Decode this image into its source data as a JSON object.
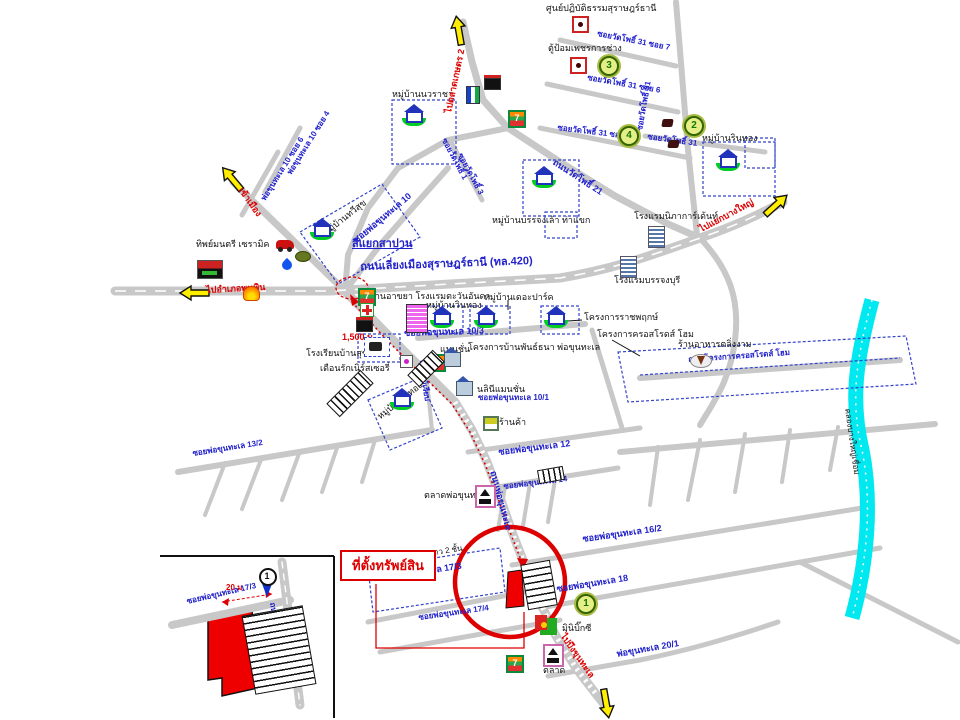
{
  "map": {
    "property_label": "ที่ตั้งทรัพย์สิน",
    "colors": {
      "road": "#c8c8c8",
      "canal": "#00e8f0",
      "route": "#dd0000",
      "road_label": "#2222cc",
      "village_box": "#3344cc",
      "arrow": "#ffee00"
    },
    "labels": [
      {
        "name": "meditation-center-label",
        "text": "ศูนย์ปฏิบัติธรรมสุราษฎร์ธานี",
        "x": 546,
        "y": 4,
        "cls": "lbl-place"
      },
      {
        "name": "police-box-label",
        "text": "ตู้ป้อมเพชรการช่าง",
        "x": 548,
        "y": 44,
        "cls": "lbl-place"
      },
      {
        "name": "soi-watpho-31-7",
        "text": "ซอยวัดโพธิ์ 31 ซอย 7",
        "x": 598,
        "y": 30,
        "rot": 11,
        "cls": "lbl-road lbl-small"
      },
      {
        "name": "soi-watpho-31-6",
        "text": "ซอยวัดโพธิ์ 31 ซอย 6",
        "x": 588,
        "y": 74,
        "rot": 10,
        "cls": "lbl-road lbl-small"
      },
      {
        "name": "soi-watpho-31-5",
        "text": "ซอยวัดโพธิ์ 31 ซอย 5",
        "x": 558,
        "y": 124,
        "rot": 7,
        "cls": "lbl-road lbl-small"
      },
      {
        "name": "soi-watpho-31-vertical",
        "text": "ซอยวัดโพธิ์ 31",
        "x": 636,
        "y": 130,
        "rot": -80,
        "cls": "lbl-road lbl-small"
      },
      {
        "name": "soi-watpho-31-b",
        "text": "ซอยวัดโพธิ์ 31",
        "x": 648,
        "y": 133,
        "rot": 8,
        "cls": "lbl-road lbl-small"
      },
      {
        "name": "rinthong-label",
        "text": "หมู่บ้านรินทอง",
        "x": 702,
        "y": 134,
        "cls": "lbl-place"
      },
      {
        "name": "nawaracha-label",
        "text": "หมู่บ้านนวราชา",
        "x": 392,
        "y": 90,
        "cls": "lbl-place"
      },
      {
        "name": "thanon-watpho-21",
        "text": "ถนนวัดโพธิ์ 21",
        "x": 556,
        "y": 158,
        "rot": 33,
        "cls": "lbl-road"
      },
      {
        "name": "soi-watpho-1",
        "text": "ซอยวัดโพธิ์ 1",
        "x": 447,
        "y": 137,
        "rot": 62,
        "cls": "lbl-road lbl-small"
      },
      {
        "name": "soi-watpho-3",
        "text": "ซอยวัดโพธิ์ 3",
        "x": 463,
        "y": 152,
        "rot": 62,
        "cls": "lbl-road lbl-small"
      },
      {
        "name": "banjonglao-label",
        "text": "หมู่บ้านบรรจงเล้า ท่าแขก",
        "x": 492,
        "y": 216,
        "cls": "lbl-place"
      },
      {
        "name": "nipha-garden-label",
        "text": "โรงแรมนิภาการ์เด้นท์",
        "x": 634,
        "y": 212,
        "cls": "lbl-place"
      },
      {
        "name": "banjongburi-label",
        "text": "โรงแรมบรรจงบุรี",
        "x": 614,
        "y": 276,
        "cls": "lbl-place"
      },
      {
        "name": "soi-pokhunthale-10",
        "text": "ซอยพ่อขุนทะเล 10",
        "x": 352,
        "y": 238,
        "rot": -40,
        "cls": "lbl-road"
      },
      {
        "name": "pokhunthale-10-soi-4",
        "text": "พ่อขุนทะเล 10 ซอย 4",
        "x": 286,
        "y": 172,
        "rot": -58,
        "cls": "lbl-road lbl-small"
      },
      {
        "name": "pokhunthale-10-soi-6",
        "text": "พ่อขุนทะเล 10 ซอย 6",
        "x": 260,
        "y": 198,
        "rot": -58,
        "cls": "lbl-road lbl-small"
      },
      {
        "name": "thawisuk-label",
        "text": "หมู่บ้านทวีสุข",
        "x": 322,
        "y": 230,
        "rot": -38,
        "cls": "lbl-place"
      },
      {
        "name": "ceramic-label",
        "text": "ทิพย์มนตรี เซรามิค",
        "x": 196,
        "y": 240,
        "cls": "lbl-place"
      },
      {
        "name": "siyaek-sapan",
        "text": "สี่แยกสาปาน",
        "x": 352,
        "y": 238,
        "cls": "lbl-road lbl-big lbl-underline"
      },
      {
        "name": "bypass-label",
        "text": "ถนนเลี่ยงเมืองสุราษฎร์ธานี (ทล.420)",
        "x": 360,
        "y": 261,
        "rot": -2,
        "cls": "lbl-road lbl-big"
      },
      {
        "name": "to-phunphin-label",
        "text": "ไปอำเภอพุนพิน",
        "x": 206,
        "y": 286,
        "rot": -3,
        "cls": "lbl-red"
      },
      {
        "name": "to-city-label",
        "text": "เข้าเมือง",
        "x": 244,
        "y": 186,
        "rot": 55,
        "cls": "lbl-red"
      },
      {
        "name": "to-market-label",
        "text": "ไปตลาดเกษตร 2",
        "x": 444,
        "y": 112,
        "rot": -78,
        "cls": "lbl-red"
      },
      {
        "name": "to-bangyai-label",
        "text": "ไปแยกบางใหญ่",
        "x": 698,
        "y": 226,
        "rot": -28,
        "cls": "lbl-red"
      },
      {
        "name": "restaurant-hotel-label",
        "text": "ร้านอาขยา โรงแรมตะวันอันดา",
        "x": 370,
        "y": 292,
        "cls": "lbl-place"
      },
      {
        "name": "winthong-label",
        "text": "หมู่บ้านวินทอง",
        "x": 426,
        "y": 301,
        "cls": "lbl-place"
      },
      {
        "name": "thepark-label",
        "text": "หมู่บ้านเดอะปาร์ค",
        "x": 484,
        "y": 293,
        "cls": "lbl-place"
      },
      {
        "name": "ratchaphruek-label",
        "text": "โครงการราชพฤกษ์",
        "x": 584,
        "y": 313,
        "cls": "lbl-place"
      },
      {
        "name": "crossroads-label",
        "text": "โครงการครอสโรดส์ โฮม",
        "x": 597,
        "y": 330,
        "cls": "lbl-place"
      },
      {
        "name": "crossroads-road-label",
        "text": "ถนนโครงการครอสโรดส์ โฮม",
        "x": 688,
        "y": 356,
        "rot": -4,
        "cls": "lbl-road lbl-small"
      },
      {
        "name": "soi-10-3",
        "text": "ซอยพ่อขุนทะเล 10/3",
        "x": 404,
        "y": 329,
        "rot": -2,
        "cls": "lbl-road"
      },
      {
        "name": "mansion-label",
        "text": "แมนชั่น",
        "x": 440,
        "y": 345,
        "cls": "lbl-place"
      },
      {
        "name": "phanthana-label",
        "text": "โครงการบ้านพันธ์ธนา พ่อขุนทะเล",
        "x": 468,
        "y": 343,
        "cls": "lbl-place"
      },
      {
        "name": "distance-1500",
        "text": "1,500 ม.",
        "x": 342,
        "y": 333,
        "cls": "lbl-red"
      },
      {
        "name": "school-label",
        "text": "โรงเรียนบ้านสุชน",
        "x": 306,
        "y": 349,
        "cls": "lbl-place"
      },
      {
        "name": "nursery-label",
        "text": "เดือนรักเนิร์สเซอรี่",
        "x": 320,
        "y": 364,
        "cls": "lbl-place"
      },
      {
        "name": "wangthong-label",
        "text": "หมู่บ้านวังทอง",
        "x": 376,
        "y": 414,
        "rot": -38,
        "cls": "lbl-place"
      },
      {
        "name": "nalini-mansion-label",
        "text": "นลินีแมนชั่น",
        "x": 477,
        "y": 385,
        "cls": "lbl-place"
      },
      {
        "name": "soi-10-1",
        "text": "ซอยพ่อขุนทะเล 10/1",
        "x": 478,
        "y": 394,
        "cls": "lbl-road lbl-small"
      },
      {
        "name": "soi-mai-riap",
        "text": "ซอยไม้เรียบ",
        "x": 424,
        "y": 360,
        "rot": 80,
        "cls": "lbl-road lbl-small"
      },
      {
        "name": "shop-label",
        "text": "ร้านค้า",
        "x": 499,
        "y": 418,
        "cls": "lbl-place"
      },
      {
        "name": "talingngam-label",
        "text": "ร้านอาหารตลิ่งงาม",
        "x": 678,
        "y": 340,
        "cls": "lbl-place"
      },
      {
        "name": "canal-label",
        "text": "คลองบางใหญ่เชื่อม",
        "x": 851,
        "y": 408,
        "rot": 82,
        "cls": "lbl-place lbl-small"
      },
      {
        "name": "soi-12",
        "text": "ซอยพ่อขุนทะเล 12",
        "x": 498,
        "y": 448,
        "rot": -7,
        "cls": "lbl-road"
      },
      {
        "name": "soi-14",
        "text": "ซอยพ่อขุนทะเล 14",
        "x": 503,
        "y": 483,
        "rot": -7,
        "cls": "lbl-road lbl-small"
      },
      {
        "name": "thanon-pokhunthale",
        "text": "ถนนพ่อขุนทะเล",
        "x": 497,
        "y": 470,
        "rot": 75,
        "cls": "lbl-road"
      },
      {
        "name": "soi-13-2",
        "text": "ซอยพ่อขุนทะเล 13/2",
        "x": 192,
        "y": 450,
        "rot": -9,
        "cls": "lbl-road lbl-small"
      },
      {
        "name": "market-pokhunthale-label",
        "text": "ตลาดพ่อขุนทะเล",
        "x": 424,
        "y": 491,
        "cls": "lbl-place"
      },
      {
        "name": "soi-16-2",
        "text": "ซอยพ่อขุนทะเล 16/2",
        "x": 582,
        "y": 535,
        "rot": -8,
        "cls": "lbl-road"
      },
      {
        "name": "soi-18",
        "text": "ซอยพ่อขุนทะเล 18",
        "x": 556,
        "y": 585,
        "rot": -9,
        "cls": "lbl-road"
      },
      {
        "name": "row-house-label",
        "text": "อาคารบ้านแถว 2 ชั้น",
        "x": 390,
        "y": 556,
        "rot": -9,
        "cls": "lbl-place lbl-small"
      },
      {
        "name": "soi-17-3",
        "text": "ซอยพ่อขุนทะเล 17/3",
        "x": 382,
        "y": 574,
        "rot": -9,
        "cls": "lbl-road"
      },
      {
        "name": "soi-17-4",
        "text": "ซอยพ่อขุนทะเล 17/4",
        "x": 418,
        "y": 614,
        "rot": -8,
        "cls": "lbl-road lbl-small"
      },
      {
        "name": "mini-bigc-label",
        "text": "มินิบิ๊กซี",
        "x": 562,
        "y": 624,
        "cls": "lbl-place"
      },
      {
        "name": "talat-label",
        "text": "ตลาด",
        "x": 543,
        "y": 666,
        "cls": "lbl-place"
      },
      {
        "name": "soi-20-1",
        "text": "พ่อขุนทะเล 20/1",
        "x": 616,
        "y": 650,
        "rot": -10,
        "cls": "lbl-road"
      },
      {
        "name": "to-bueng-label",
        "text": "ไปบึงขุนทะเล",
        "x": 566,
        "y": 632,
        "rot": 55,
        "cls": "lbl-red"
      },
      {
        "name": "distance-20m",
        "text": "20 ม.",
        "x": 226,
        "y": 584,
        "cls": "lbl-red lbl-small"
      },
      {
        "name": "inset-soi-label",
        "text": "ซอยพ่อขุนทะเล 17/3",
        "x": 186,
        "y": 598,
        "rot": -13,
        "cls": "lbl-road lbl-small"
      },
      {
        "name": "inset-road-label",
        "text": "ถนนพ่อขุนทะเล",
        "x": 276,
        "y": 602,
        "rot": 82,
        "cls": "lbl-road lbl-small"
      }
    ],
    "icons": [
      {
        "type": "reddot",
        "name": "meditation-center-icon",
        "x": 572,
        "y": 16
      },
      {
        "type": "reddot",
        "name": "police-box-icon",
        "x": 570,
        "y": 57
      },
      {
        "type": "cnum",
        "name": "circle-3",
        "x": 599,
        "y": 56,
        "n": "3"
      },
      {
        "type": "cnum",
        "name": "circle-4",
        "x": 619,
        "y": 126,
        "n": "4"
      },
      {
        "type": "cnum",
        "name": "circle-2",
        "x": 684,
        "y": 116,
        "n": "2"
      },
      {
        "type": "cnum",
        "name": "circle-1",
        "x": 576,
        "y": 594,
        "n": "1"
      },
      {
        "type": "dark",
        "name": "house-mark-a",
        "x": 662,
        "y": 119
      },
      {
        "type": "dark",
        "name": "house-mark-b",
        "x": 668,
        "y": 140
      },
      {
        "type": "house",
        "name": "village-nawaracha-icon",
        "x": 402,
        "y": 108
      },
      {
        "type": "house",
        "name": "village-thawisuk-icon",
        "x": 310,
        "y": 222
      },
      {
        "type": "house",
        "name": "village-banjonglao-icon",
        "x": 532,
        "y": 170
      },
      {
        "type": "house",
        "name": "village-rinthong-icon",
        "x": 716,
        "y": 153
      },
      {
        "type": "house",
        "name": "village-winthong-icon",
        "x": 430,
        "y": 310
      },
      {
        "type": "house",
        "name": "village-thepark-icon",
        "x": 474,
        "y": 310
      },
      {
        "type": "house",
        "name": "village-ratchaphruek-icon",
        "x": 544,
        "y": 310
      },
      {
        "type": "house",
        "name": "village-wangthong-icon",
        "x": 390,
        "y": 392
      },
      {
        "type": "bldg",
        "name": "nipha-garden-icon",
        "x": 648,
        "y": 226
      },
      {
        "type": "bldg",
        "name": "banjongburi-icon",
        "x": 620,
        "y": 256
      },
      {
        "type": "pink",
        "name": "tawan-anda-hotel-icon",
        "x": 406,
        "y": 304
      },
      {
        "type": "seven",
        "name": "seven-eleven-1",
        "x": 508,
        "y": 110
      },
      {
        "type": "seven",
        "name": "seven-eleven-2",
        "x": 358,
        "y": 288
      },
      {
        "type": "seven",
        "name": "seven-eleven-3",
        "x": 428,
        "y": 354
      },
      {
        "type": "seven",
        "name": "seven-eleven-4",
        "x": 506,
        "y": 655
      },
      {
        "type": "cross",
        "name": "pharmacy-icon",
        "x": 360,
        "y": 303
      },
      {
        "type": "ptt",
        "name": "gas-sign-icon",
        "x": 466,
        "y": 86
      },
      {
        "type": "sign",
        "name": "store-sign-icon",
        "x": 484,
        "y": 78
      },
      {
        "type": "sign",
        "name": "store-sign-2-icon",
        "x": 356,
        "y": 320
      },
      {
        "type": "lotus",
        "name": "lotus-sign-icon",
        "x": 197,
        "y": 260
      },
      {
        "type": "shell",
        "name": "shell-station-icon",
        "x": 243,
        "y": 286
      },
      {
        "type": "car",
        "name": "ceramic-shop-icon",
        "x": 276,
        "y": 240
      },
      {
        "type": "drop",
        "name": "fuel-drop-icon",
        "x": 281,
        "y": 257
      },
      {
        "type": "blob",
        "name": "fuel-blob-icon",
        "x": 295,
        "y": 251
      },
      {
        "type": "magenta",
        "name": "shop-dot-icon",
        "x": 400,
        "y": 355
      },
      {
        "type": "school",
        "name": "school-icon",
        "x": 364,
        "y": 337
      },
      {
        "type": "mansion",
        "name": "mansion-icon",
        "x": 444,
        "y": 352
      },
      {
        "type": "mansion",
        "name": "nalini-mansion-icon",
        "x": 456,
        "y": 381
      },
      {
        "type": "shop",
        "name": "shop-icon",
        "x": 483,
        "y": 416
      },
      {
        "type": "shrine",
        "name": "market-shrine-icon",
        "x": 475,
        "y": 485
      },
      {
        "type": "shrine",
        "name": "talat-shrine-icon",
        "x": 543,
        "y": 644
      },
      {
        "type": "mbc",
        "name": "mini-bigc-icon",
        "x": 540,
        "y": 618
      },
      {
        "type": "plate",
        "name": "restaurant-icon",
        "x": 690,
        "y": 354
      },
      {
        "type": "pin",
        "name": "inset-pin",
        "x": 258,
        "y": 568,
        "n": "1"
      }
    ],
    "bars": [
      {
        "name": "rowhouse-bar-1",
        "x": 408,
        "y": 360,
        "w": 34,
        "h": 15,
        "rot": -45,
        "dir": "v"
      },
      {
        "name": "rowhouse-bar-2",
        "x": 326,
        "y": 384,
        "w": 46,
        "h": 17,
        "rot": -45,
        "dir": "v"
      },
      {
        "name": "rowhouse-bar-3",
        "x": 538,
        "y": 468,
        "w": 24,
        "h": 12,
        "rot": -10,
        "dir": "v"
      },
      {
        "name": "property-rows",
        "x": 524,
        "y": 562,
        "w": 28,
        "h": 44,
        "rot": -10,
        "dir": "h"
      },
      {
        "name": "inset-rows",
        "x": 248,
        "y": 610,
        "w": 60,
        "h": 78,
        "rot": -10,
        "dir": "h"
      }
    ]
  }
}
